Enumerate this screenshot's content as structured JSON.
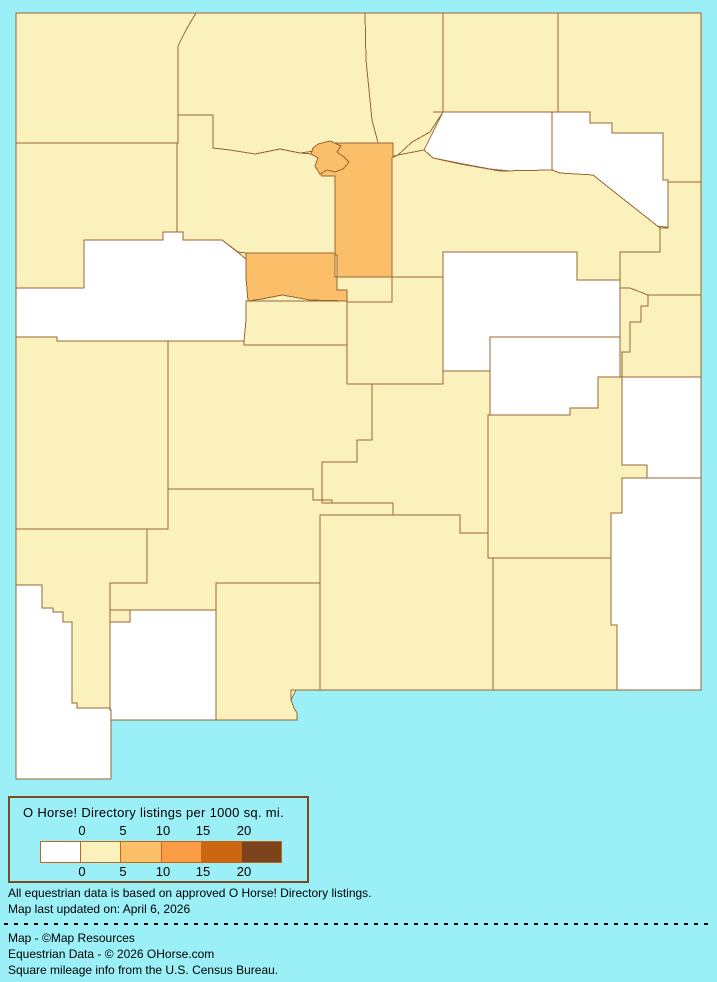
{
  "palette": {
    "background": "#9BEFF7",
    "county_border": "#996633",
    "legend_box_border": "#7B4A1E",
    "ramp_border": "#C2661D",
    "text": "#000000",
    "levels": {
      "none": "#FFFFFF",
      "low": "#FBF1BD",
      "mid": "#FBBE69"
    }
  },
  "legend": {
    "title": "O Horse! Directory listings per 1000 sq. mi.",
    "ticks": [
      "0",
      "5",
      "10",
      "15",
      "20"
    ],
    "swatches": [
      {
        "range": "0",
        "color": "#FFFFFF"
      },
      {
        "range": "0-5",
        "color": "#FBF1BD"
      },
      {
        "range": "5-10",
        "color": "#FBBE69"
      },
      {
        "range": "10-15",
        "color": "#F99C45"
      },
      {
        "range": "15-20",
        "color": "#CC6611"
      },
      {
        "range": "20+",
        "color": "#7B441C"
      }
    ]
  },
  "footer": {
    "note_line1": "All equestrian data is based on approved O Horse! Directory listings.",
    "note_line2": "Map last updated on: April 6, 2026",
    "credit_line1": "Map - ©Map Resources",
    "credit_line2": "Equestrian Data - © 2026 OHorse.com",
    "credit_line3": "Square mileage info from the U.S. Census Bureau."
  },
  "map": {
    "region": "New Mexico counties choropleth",
    "counties": [
      {
        "id": "san-juan",
        "level": "low"
      },
      {
        "id": "rio-arriba",
        "level": "low"
      },
      {
        "id": "taos",
        "level": "low"
      },
      {
        "id": "colfax",
        "level": "low"
      },
      {
        "id": "union",
        "level": "low"
      },
      {
        "id": "mckinley",
        "level": "low"
      },
      {
        "id": "sandoval",
        "level": "low"
      },
      {
        "id": "los-alamos",
        "level": "mid"
      },
      {
        "id": "santa-fe",
        "level": "mid"
      },
      {
        "id": "mora",
        "level": "none"
      },
      {
        "id": "harding",
        "level": "none"
      },
      {
        "id": "san-miguel",
        "level": "low"
      },
      {
        "id": "quay",
        "level": "low"
      },
      {
        "id": "cibola",
        "level": "none"
      },
      {
        "id": "valencia",
        "level": "low"
      },
      {
        "id": "bernalillo",
        "level": "mid"
      },
      {
        "id": "torrance",
        "level": "low"
      },
      {
        "id": "guadalupe",
        "level": "none"
      },
      {
        "id": "curry",
        "level": "low"
      },
      {
        "id": "de-baca",
        "level": "none"
      },
      {
        "id": "catron",
        "level": "low"
      },
      {
        "id": "socorro",
        "level": "low"
      },
      {
        "id": "lincoln",
        "level": "low"
      },
      {
        "id": "roosevelt",
        "level": "none"
      },
      {
        "id": "chaves",
        "level": "low"
      },
      {
        "id": "grant",
        "level": "low"
      },
      {
        "id": "sierra",
        "level": "low"
      },
      {
        "id": "luna",
        "level": "none"
      },
      {
        "id": "hidalgo",
        "level": "none"
      },
      {
        "id": "dona-ana",
        "level": "low"
      },
      {
        "id": "otero",
        "level": "low"
      },
      {
        "id": "eddy",
        "level": "low"
      },
      {
        "id": "lea",
        "level": "none"
      }
    ]
  }
}
